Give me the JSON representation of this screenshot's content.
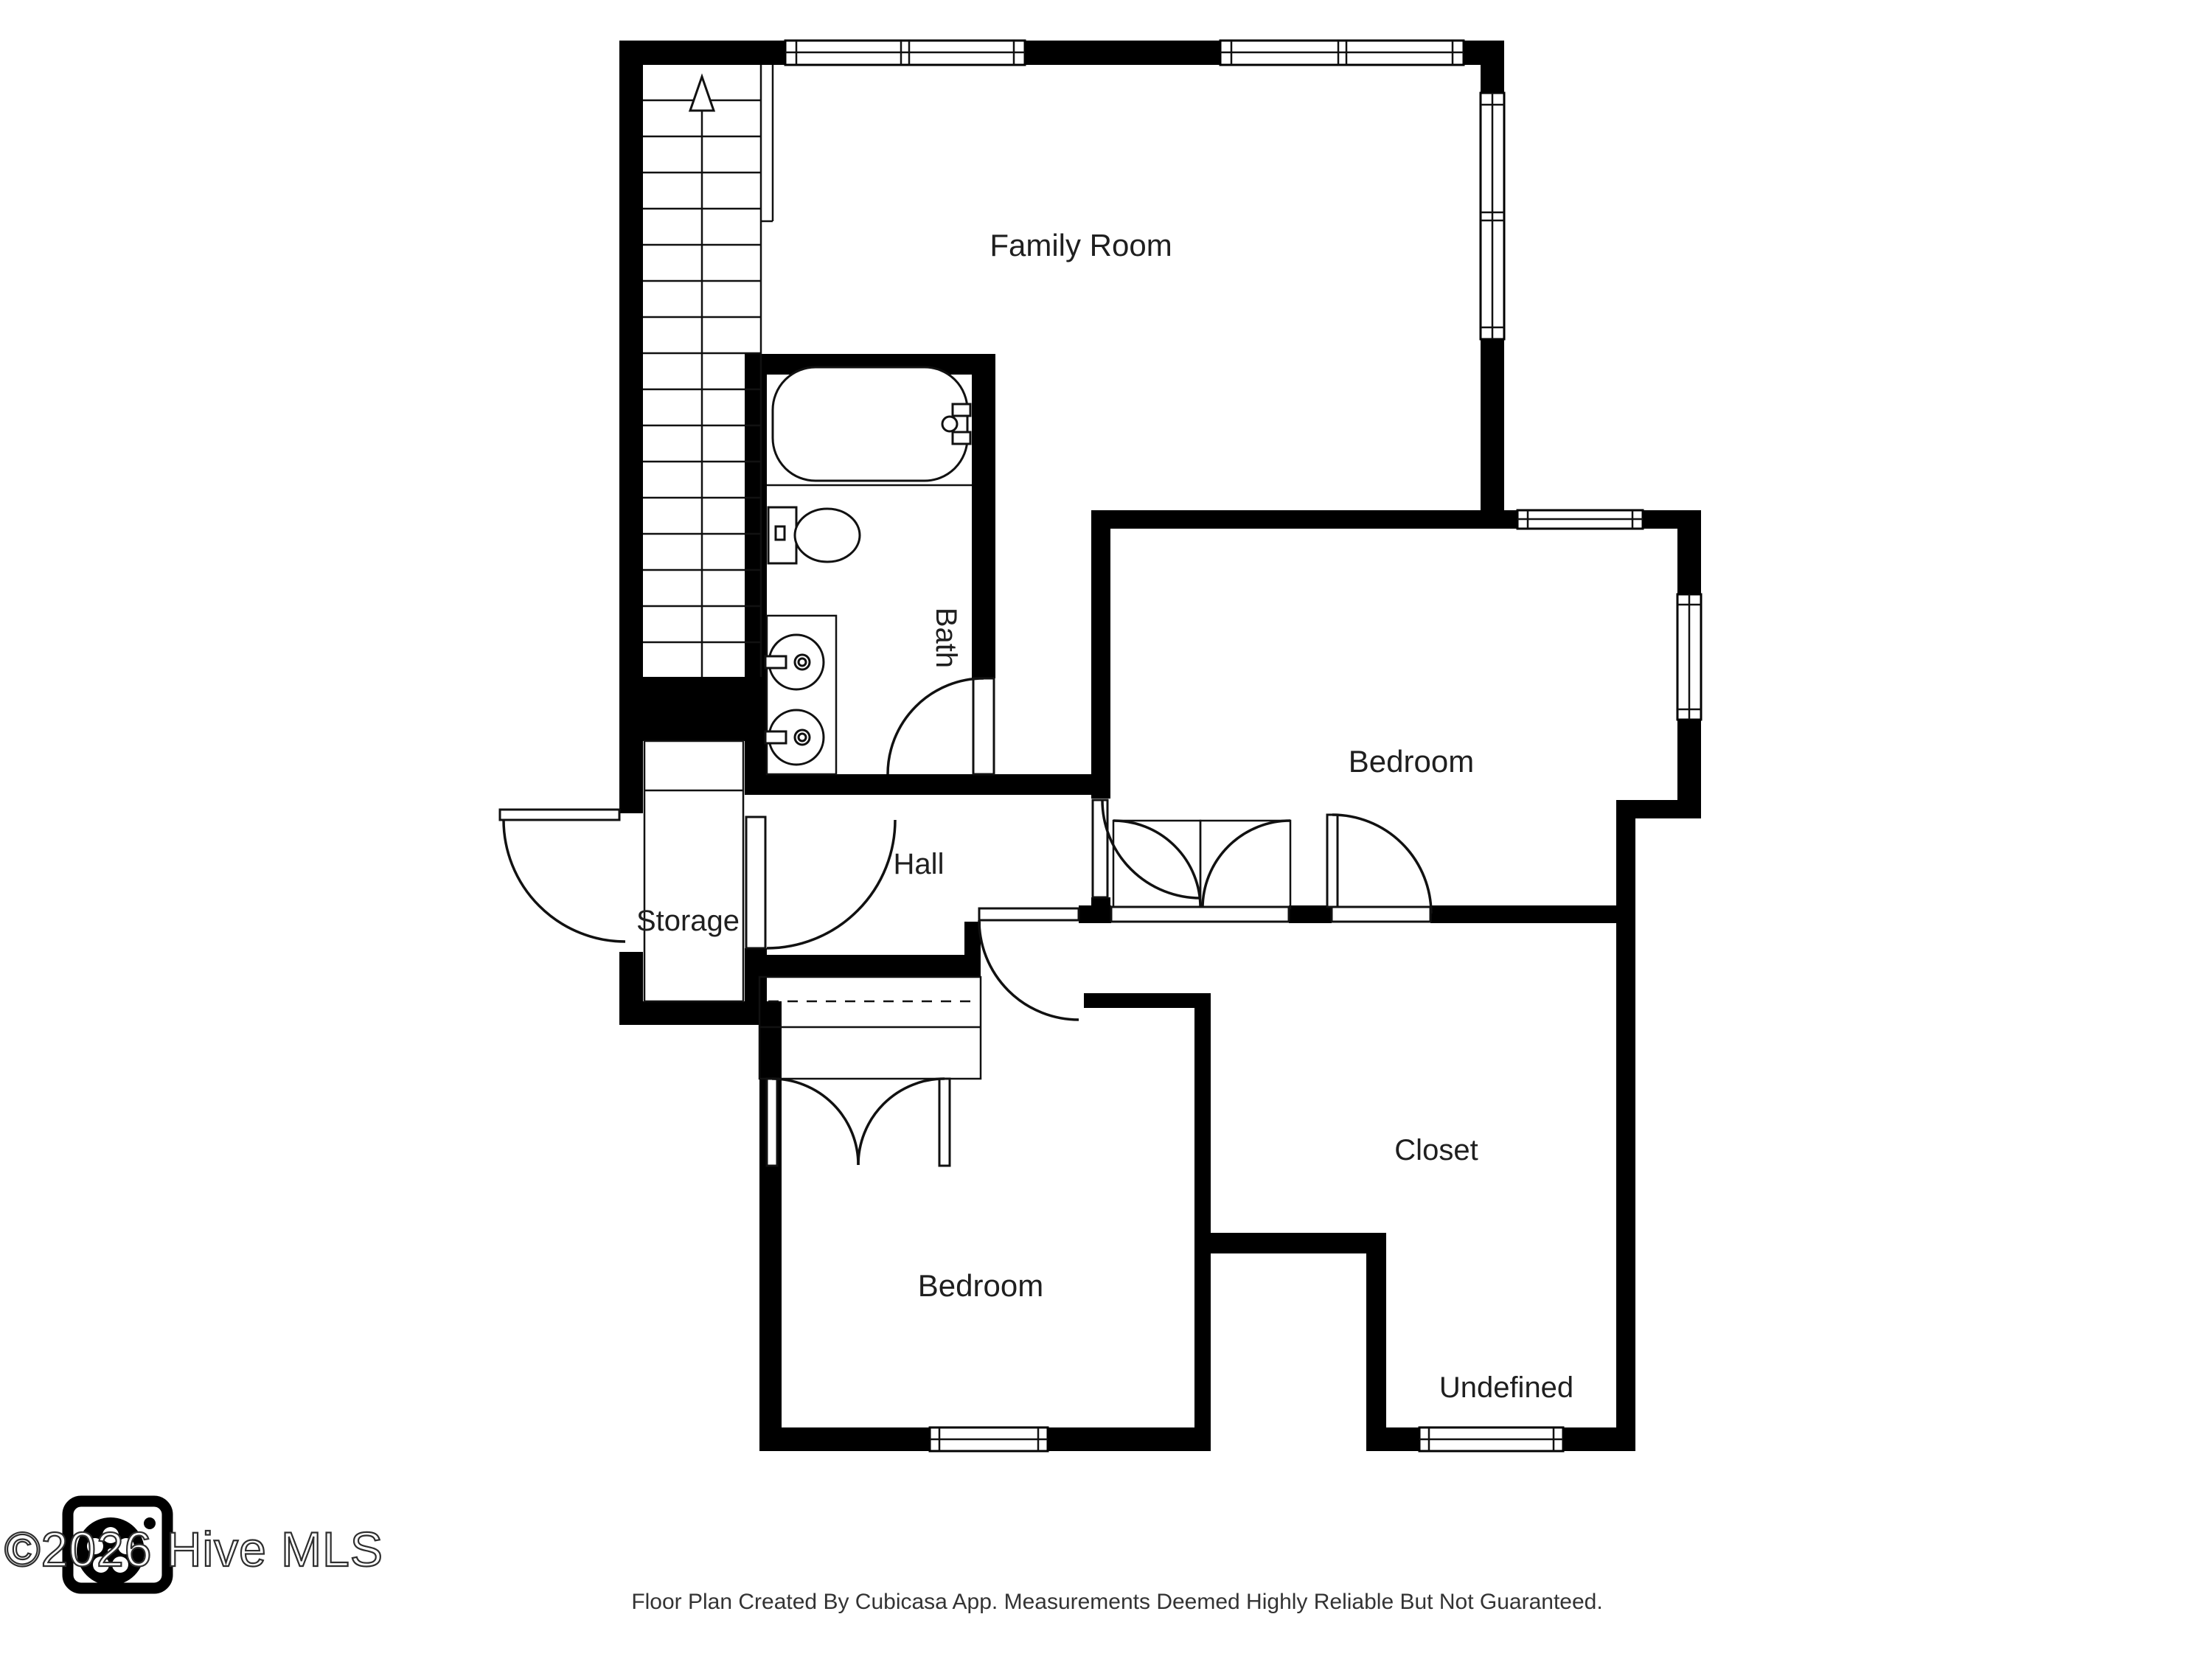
{
  "floor_plan": {
    "rooms": {
      "family_room": {
        "label": "Family Room"
      },
      "bath": {
        "label": "Bath"
      },
      "bedroom_right": {
        "label": "Bedroom"
      },
      "storage": {
        "label": "Storage"
      },
      "hall": {
        "label": "Hall"
      },
      "bedroom_bottom": {
        "label": "Bedroom"
      },
      "closet": {
        "label": "Closet"
      },
      "undefined_room": {
        "label": "Undefined"
      }
    },
    "footer": {
      "disclaimer": "Floor Plan Created By Cubicasa App. Measurements Deemed Highly Reliable But Not Guaranteed."
    },
    "watermark": {
      "text": "©2026 Hive MLS"
    },
    "colors": {
      "wall": "#000000",
      "background": "#ffffff",
      "label": "#1f1f1f",
      "footer": "#333333",
      "watermark_outline": "#2e2e2e"
    }
  }
}
